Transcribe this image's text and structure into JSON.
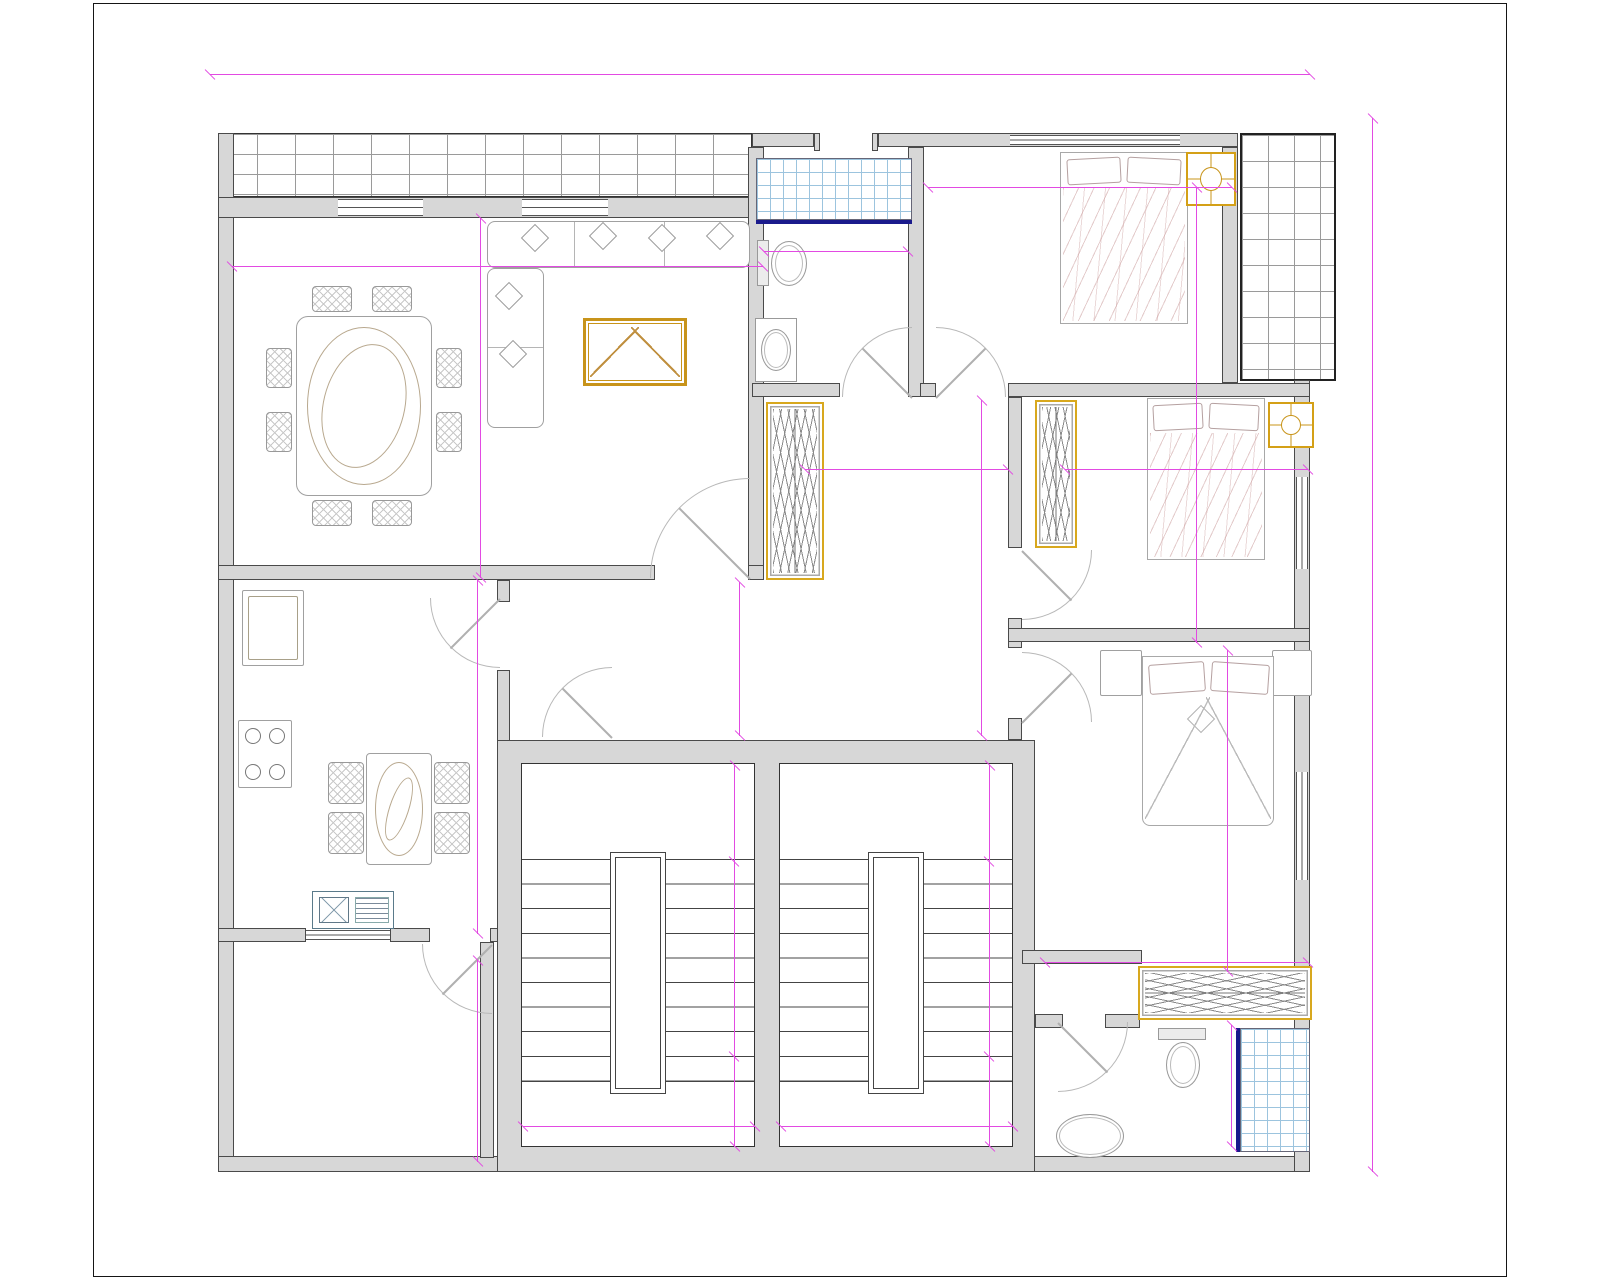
{
  "drawing": {
    "type": "floor-plan",
    "rooms": [
      {
        "id": "sejour",
        "name": "Séjour",
        "area": "S=29.48m²"
      },
      {
        "id": "cuisine",
        "name": "Cuisine",
        "area": "S=14.30m²"
      },
      {
        "id": "hall",
        "name": "Hall",
        "area": "S=18.33m²"
      },
      {
        "id": "terrasse",
        "name": "Terrasse",
        "area": "S=8.12m²"
      },
      {
        "id": "sdb-haut",
        "name": "SDB",
        "area": "S=5.85m²"
      },
      {
        "id": "chambre-01",
        "name": "Chambre 01",
        "area": "S=11.10m²"
      },
      {
        "id": "chambre-02",
        "name": "Chambre 02",
        "area": "S=10.35m²"
      },
      {
        "id": "suite",
        "name": "Suite",
        "area": "S=20.37m²"
      },
      {
        "id": "sdb-bas",
        "name": "SDB",
        "area": "S=4.87m²"
      }
    ],
    "dims": {
      "overall_width": "14.00",
      "overall_height": "13.00",
      "sejour_w": "6.55",
      "sejour_h": "4.50",
      "sdb_top_w": "1.58",
      "ch01_w": "3.70",
      "ch01_h": "3.00",
      "hall_w": "2.60",
      "hall_h": "4.15",
      "hall_s": "1.90",
      "ch02_w": "3.00",
      "ch02_h": "3.00",
      "cuisine_h": "4.40",
      "terrasse_h": "2.50",
      "suite_h": "4.00",
      "suite_w": "3.25",
      "sdb_bottom_h": "1.50",
      "stair_top": "1.20",
      "stair_mid": "2.40",
      "stair_bottom": "1.20",
      "stair_w": "3.00"
    },
    "colors": {
      "dimension": "#e24ae2",
      "area_text": "#1f9f9f",
      "room_text": "#585858",
      "wall_fill": "#d7d7d7",
      "accent_gold": "#d4a017",
      "tile_blue": "#9cc4de",
      "navy": "#1a1a8c"
    }
  }
}
